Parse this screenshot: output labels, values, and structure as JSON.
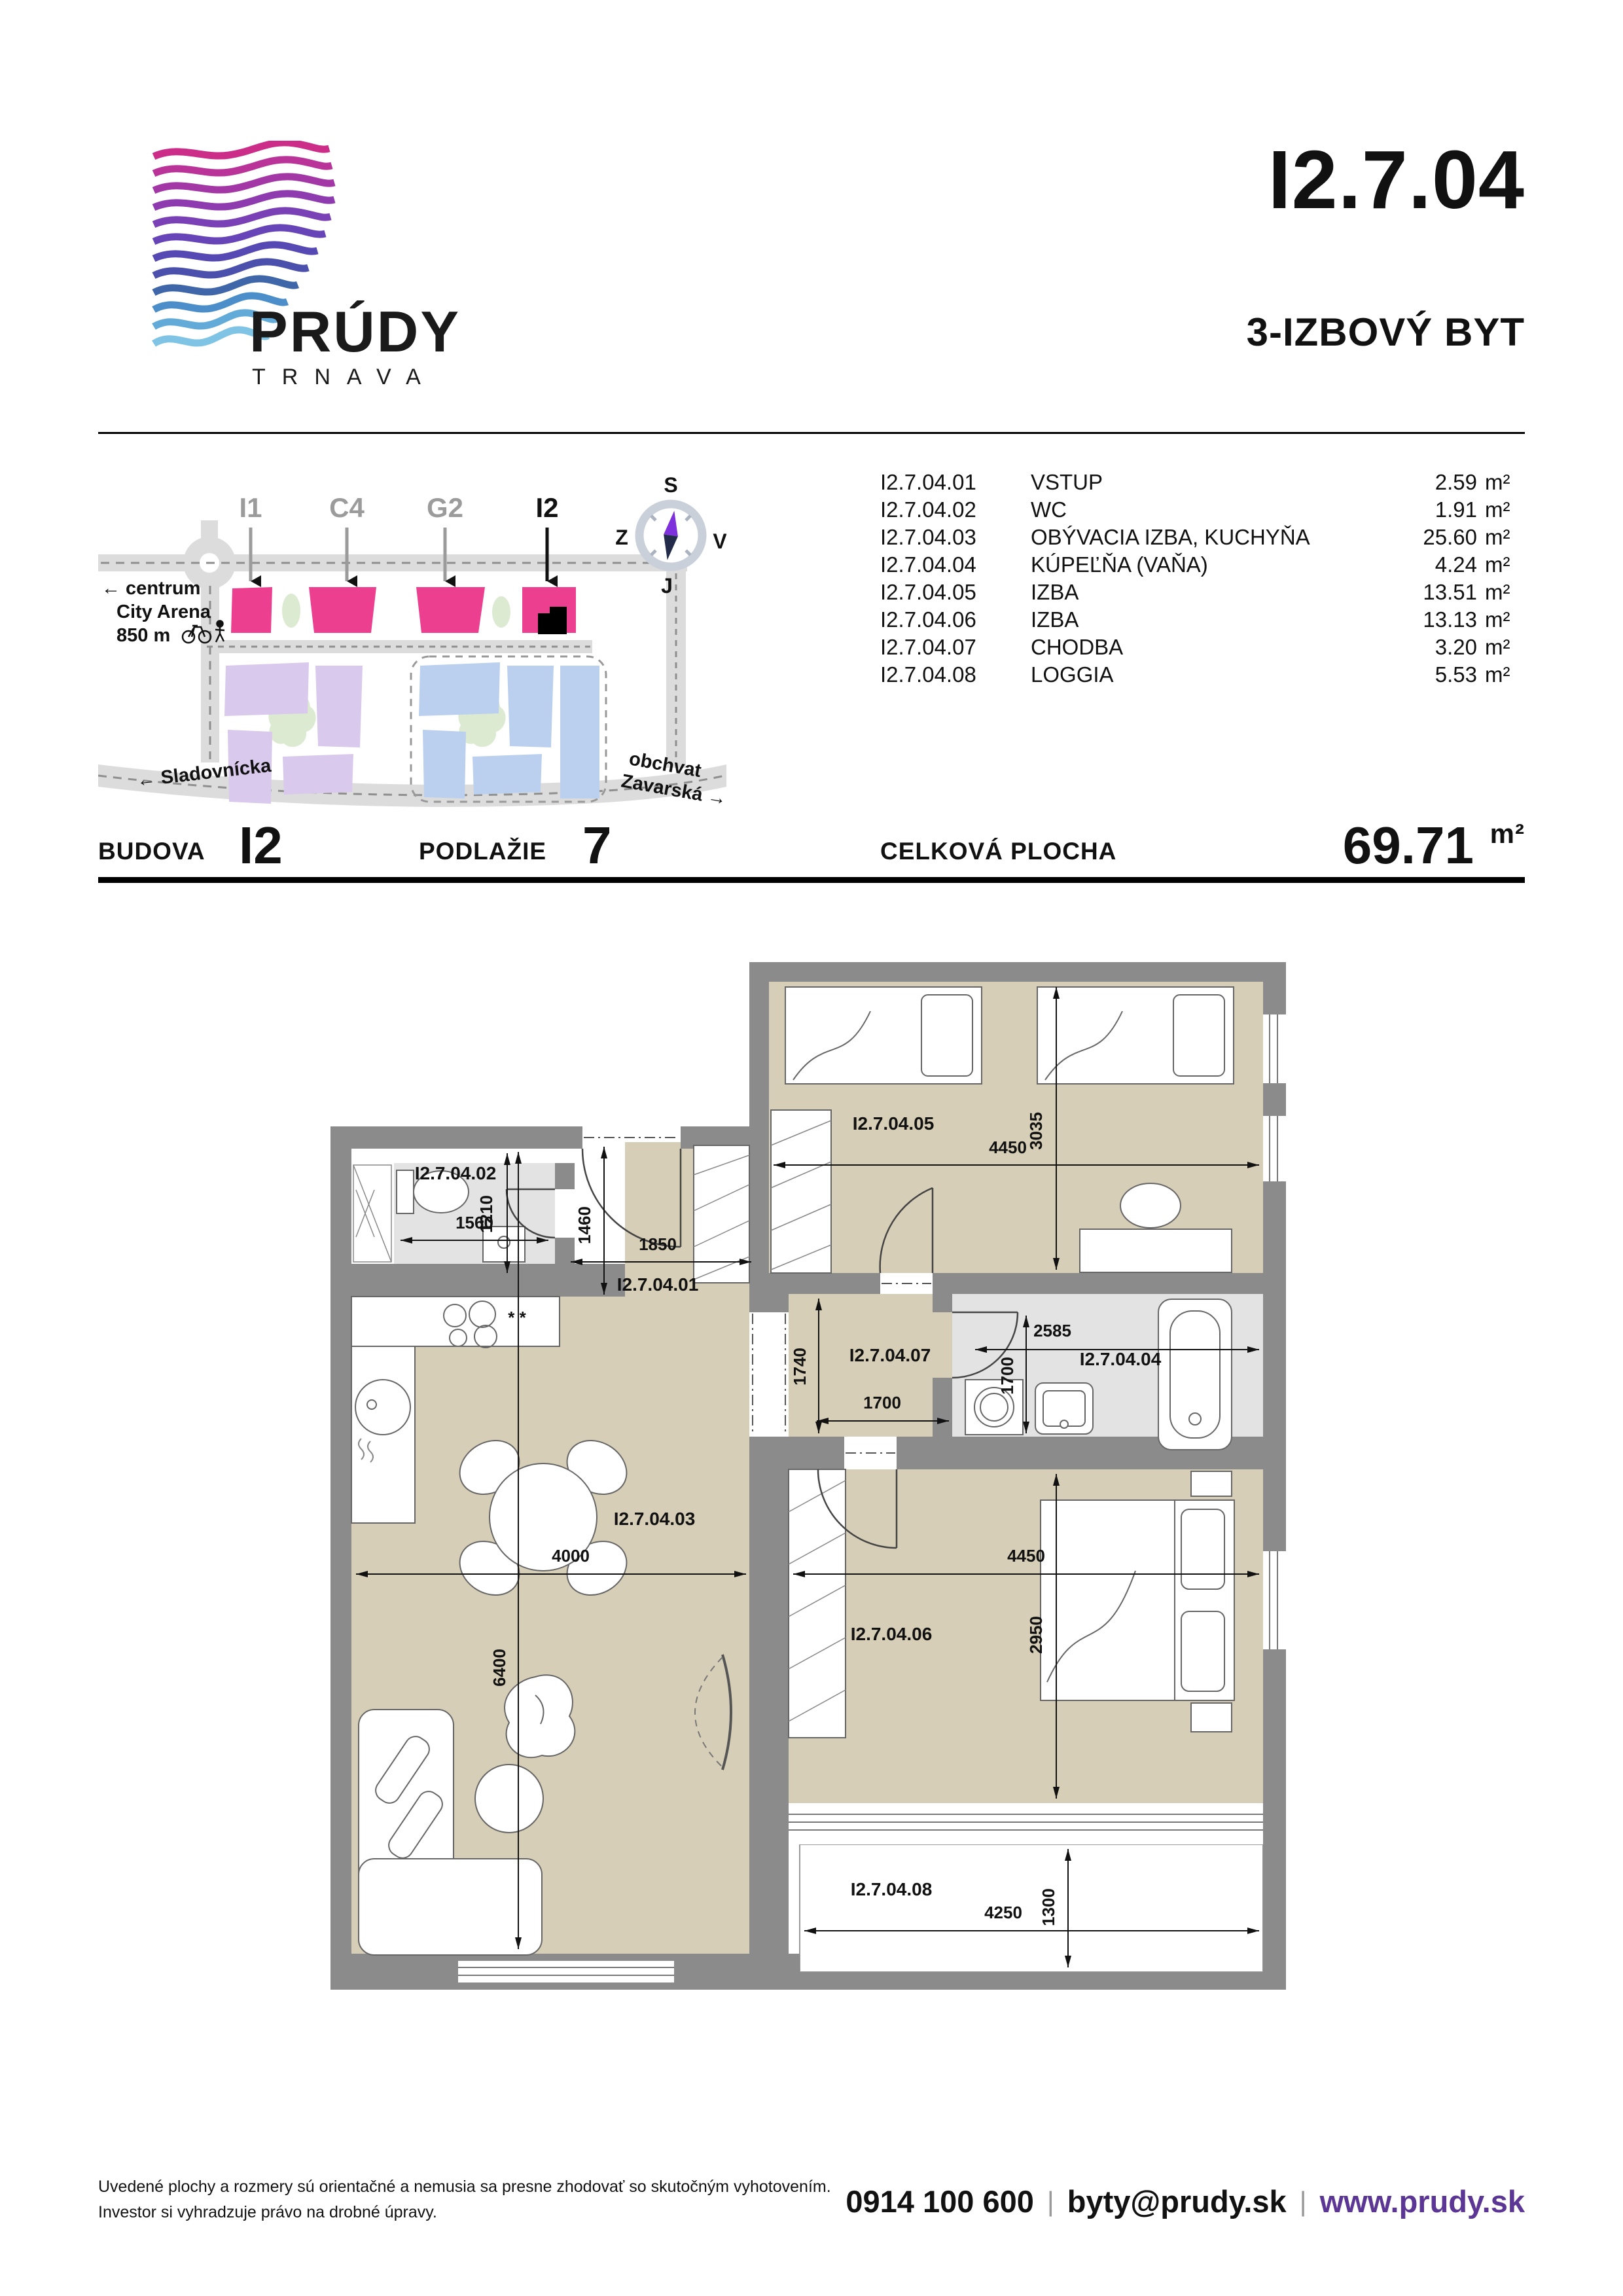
{
  "header": {
    "logo": {
      "brand": "PRÚDY",
      "city": "TRNAVA"
    },
    "unit_code": "I2.7.04",
    "unit_type": "3-IZBOVÝ BYT"
  },
  "site_map": {
    "building_labels": [
      {
        "id": "I1",
        "active": false
      },
      {
        "id": "C4",
        "active": false
      },
      {
        "id": "G2",
        "active": false
      },
      {
        "id": "I2",
        "active": true
      }
    ],
    "centrum_line1": "← centrum",
    "centrum_line2": "City Arena",
    "centrum_line3": "850 m",
    "street_left": "← Sladovnícka",
    "street_right_line1": "obchvat",
    "street_right_line2": "Zavarská →",
    "compass": {
      "n": "S",
      "s": "J",
      "w": "Z",
      "e": "V"
    }
  },
  "room_table": {
    "rows": [
      {
        "code": "I2.7.04.01",
        "name": "VSTUP",
        "area": "2.59",
        "unit": "m²"
      },
      {
        "code": "I2.7.04.02",
        "name": "WC",
        "area": "1.91",
        "unit": "m²"
      },
      {
        "code": "I2.7.04.03",
        "name": "OBÝVACIA IZBA, KUCHYŇA",
        "area": "25.60",
        "unit": "m²"
      },
      {
        "code": "I2.7.04.04",
        "name": "KÚPEĽŇA (VAŇA)",
        "area": "4.24",
        "unit": "m²"
      },
      {
        "code": "I2.7.04.05",
        "name": "IZBA",
        "area": "13.51",
        "unit": "m²"
      },
      {
        "code": "I2.7.04.06",
        "name": "IZBA",
        "area": "13.13",
        "unit": "m²"
      },
      {
        "code": "I2.7.04.07",
        "name": "CHODBA",
        "area": "3.20",
        "unit": "m²"
      },
      {
        "code": "I2.7.04.08",
        "name": "LOGGIA",
        "area": "5.53",
        "unit": "m²"
      }
    ]
  },
  "summary": {
    "budova_label": "BUDOVA",
    "budova_value": "I2",
    "podlazie_label": "PODLAŽIE",
    "podlazie_value": "7",
    "plocha_label": "CELKOVÁ PLOCHA",
    "plocha_value": "69.71",
    "plocha_unit": "m²"
  },
  "floor_plan": {
    "rooms": {
      "r01": "I2.7.04.01",
      "r02": "I2.7.04.02",
      "r03": "I2.7.04.03",
      "r04": "I2.7.04.04",
      "r05": "I2.7.04.05",
      "r06": "I2.7.04.06",
      "r07": "I2.7.04.07",
      "r08": "I2.7.04.08"
    },
    "dims": {
      "wc_w": "1560",
      "wc_h": "1210",
      "entry_h": "1460",
      "entry_w": "1850",
      "r05_w": "4450",
      "r05_h": "3035",
      "bath_w": "2585",
      "bath_h": "1700",
      "corr_h": "1740",
      "corr_w": "1700",
      "liv_w": "4000",
      "liv_h": "6400",
      "r06_w": "4450",
      "r06_h": "2950",
      "log_w": "4250",
      "log_h": "1300"
    },
    "kitchen_marks": "* *"
  },
  "footer": {
    "disclaimer_line1": "Uvedené plochy a rozmery sú orientačné a nemusia sa presne zhodovať so skutočným vyhotovením.",
    "disclaimer_line2": "Investor si vyhradzuje právo na drobné úpravy.",
    "phone": "0914 100 600",
    "email": "byty@prudy.sk",
    "website": "www.prudy.sk",
    "separator": "|"
  },
  "colors": {
    "accent_pink": "#ec3f8f",
    "link_purple": "#5b3694",
    "floor_beige": "#d6ceb6",
    "tile_gray": "#e3e3e3",
    "wall_gray": "#8b8b8b",
    "map_purple": "#d9c9ec",
    "map_blue": "#bad0ee",
    "map_green": "#dcead2",
    "road_gray": "#dcdcdc",
    "compass_ring": "#c9d0da",
    "needle_purple": "#7e30dd",
    "needle_navy": "#232b4a"
  }
}
